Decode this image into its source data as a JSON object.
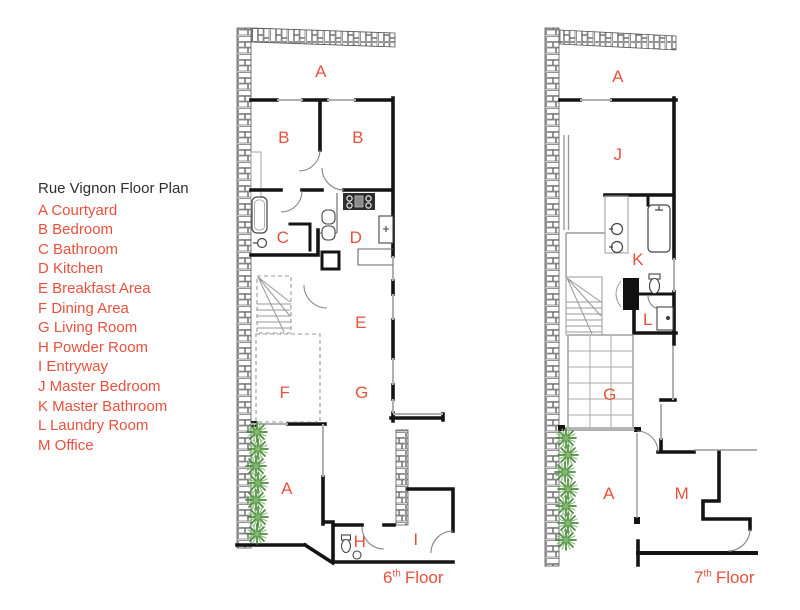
{
  "colors": {
    "accent_red": "#e8513f",
    "ink": "#2e2e2e",
    "wall_black": "#141414",
    "window_gray": "#b0b0b0",
    "line_gray": "#8a8a8a",
    "plant_green": "#5a9048"
  },
  "legend": {
    "title": "Rue Vignon Floor Plan",
    "items": [
      "A Courtyard",
      "B Bedroom",
      "C Bathroom",
      "D Kitchen",
      "E Breakfast Area",
      "F Dining Area",
      "G Living Room",
      "H Powder Room",
      "I Entryway",
      "J Master Bedroom",
      "K Master Bathroom",
      "L Laundry Room",
      "M Office"
    ]
  },
  "floors": [
    {
      "name": "6th Floor plan",
      "caption": {
        "number": "6",
        "suffix": "th",
        "word": "Floor"
      },
      "labels": [
        "A",
        "B",
        "B",
        "C",
        "D",
        "E",
        "F",
        "G",
        "A",
        "H",
        "I"
      ]
    },
    {
      "name": "7th Floor plan",
      "caption": {
        "number": "7",
        "suffix": "th",
        "word": "Floor"
      },
      "labels": [
        "A",
        "J",
        "K",
        "L",
        "G",
        "A",
        "M"
      ]
    }
  ]
}
